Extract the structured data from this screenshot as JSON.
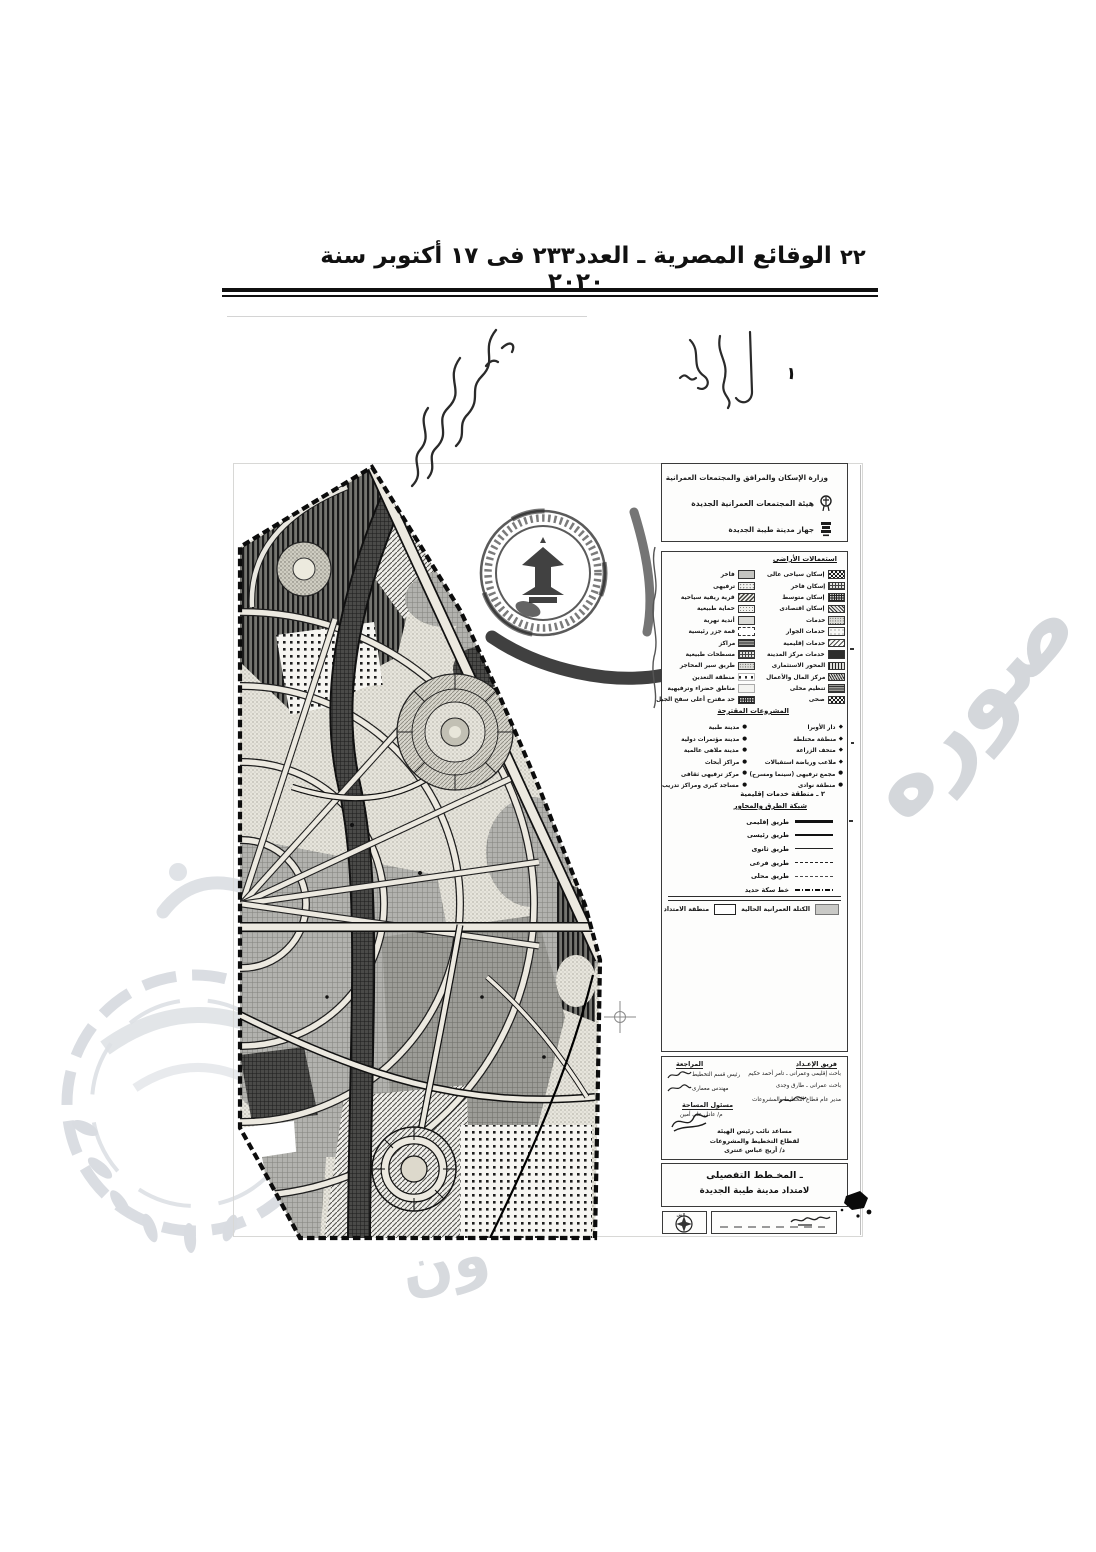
{
  "header": {
    "gazette_title": "الوقائع المصرية ـ العدد٢٣٣ فى ١٧ أكتوبر سنة ٢٠٢٠",
    "page_number": "٢٢"
  },
  "agency_panel": {
    "rows": [
      {
        "label": "وزارة الإسكان والمرافق والمجتمعات العمرانية",
        "icon": "egypt-eagle"
      },
      {
        "label": "هيئة المجتمعات العمرانية الجديدة",
        "icon": "authority-logo"
      },
      {
        "label": "جهاز مدينة طيبة الجديدة",
        "icon": "city-logo"
      }
    ]
  },
  "legend": {
    "landuse_title": "استعمالات الأراضى",
    "landuse_right": [
      {
        "label": "إسكان سياحى عالى",
        "pattern": "checker"
      },
      {
        "label": "إسكان فاخر",
        "pattern": "crosshatch"
      },
      {
        "label": "إسكان متوسط",
        "pattern": "grid"
      },
      {
        "label": "إسكان اقتصادى",
        "pattern": "diagdense"
      },
      {
        "label": "خدمات",
        "pattern": "stipple"
      },
      {
        "label": "خدمات الجوار",
        "pattern": "lightdots"
      },
      {
        "label": "خدمات إقليمية",
        "pattern": "hatch"
      },
      {
        "label": "خدمات مركز المدينة",
        "pattern": "dark"
      },
      {
        "label": "المحور الاستثمارى",
        "pattern": "vstripes"
      },
      {
        "label": "مركز المال والأعمال",
        "pattern": "scribble"
      },
      {
        "label": "تنظيم محلى",
        "pattern": "weave"
      },
      {
        "label": "صحى",
        "pattern": "checker"
      }
    ],
    "landuse_left": [
      {
        "label": "فاخر",
        "pattern": "gray"
      },
      {
        "label": "ترفيهى",
        "pattern": "dots"
      },
      {
        "label": "قرية ريفية سياحية",
        "pattern": "zigzag"
      },
      {
        "label": "حماية طبيعية",
        "pattern": "stipplelight"
      },
      {
        "label": "أندية نهرية",
        "pattern": "lightgray"
      },
      {
        "label": "قمة جزر رئيسية",
        "pattern": "open"
      },
      {
        "label": "مراكز",
        "pattern": "weave"
      },
      {
        "label": "مسطحات طبيعية",
        "pattern": "crosshatch"
      },
      {
        "label": "طريق سير المحاجر",
        "pattern": "stipple"
      },
      {
        "label": "منطقة التعدين",
        "pattern": "sqdots"
      },
      {
        "label": "مناطق خضراء وترفيهية",
        "pattern": "blank"
      },
      {
        "label": "حد مقترح أعلى سفح الجبل",
        "pattern": "grid"
      }
    ],
    "projects_title": "المشروعات المقترحة",
    "projects_right": [
      {
        "label": "دار الأوبرا"
      },
      {
        "label": "منطقة مختلطة"
      },
      {
        "label": "متحف الزراعة"
      },
      {
        "label": "ملاعب ورياضة استقبالات"
      },
      {
        "label": "مجمع ترفيهى (سينما ومسرح)"
      },
      {
        "label": "منطقة نوادى"
      }
    ],
    "projects_left": [
      {
        "label": "مدينة طبية"
      },
      {
        "label": "مدينة مؤتمرات دولية"
      },
      {
        "label": "مدينة ملاهى عالمية"
      },
      {
        "label": "مراكز أبحاث"
      },
      {
        "label": "مركز ترفيهى ثقافى"
      },
      {
        "label": "مساجد كبرى ومراكز تدريب"
      }
    ],
    "regional_note": "٢ ـ منطقة خدمات إقليمية",
    "roads_title": "شبكة الطرق والمحاور",
    "roads": [
      {
        "label": "طريق إقليمى",
        "style": "thick"
      },
      {
        "label": "طريق رئيسى",
        "style": "solid"
      },
      {
        "label": "طريق ثانوى",
        "style": "med"
      },
      {
        "label": "طريق فرعى",
        "style": "dashed"
      },
      {
        "label": "طريق محلى",
        "style": "sparse"
      },
      {
        "label": "خط سكة حديد",
        "style": "rail"
      }
    ],
    "existing_urban_label": "الكتلة العمرانية الحالية",
    "extension_label": "منطقة الامتداد"
  },
  "signatures": {
    "right_header": "فريق الإعـداد",
    "left_header": "المراجعة",
    "right_rows": [
      "باحث إقليمى وعمرانى ـ تامر أحمد حكيم",
      "باحث عمرانى ـ طارق وجدى",
      "مدير عام قطاع التخطيط والمشروعات"
    ],
    "left_rows": [
      "رئيس قسم التخطيط",
      "مهندس معمارى"
    ],
    "survey_header": "مسئول المساحة",
    "survey_rows": [
      "م/ عادل على أمين"
    ],
    "approval_lines": [
      "مساعد نائب رئيس الهيئة",
      "لقطاع التخطيط والمشروعات",
      "د/ أريج عباس عنترى"
    ]
  },
  "map_title": {
    "line1": "ـ المخـطط التفصيلى",
    "line2": "لامتداد مدينة طيبة الجديدة"
  },
  "compass": {
    "north_letter": "ش"
  },
  "watermark": {
    "text1": "صوره",
    "text2": "ون"
  },
  "colors": {
    "ink": "#111111",
    "scan_gray": "#c9c9c9",
    "watermark_gray": "#d5d8dc"
  }
}
